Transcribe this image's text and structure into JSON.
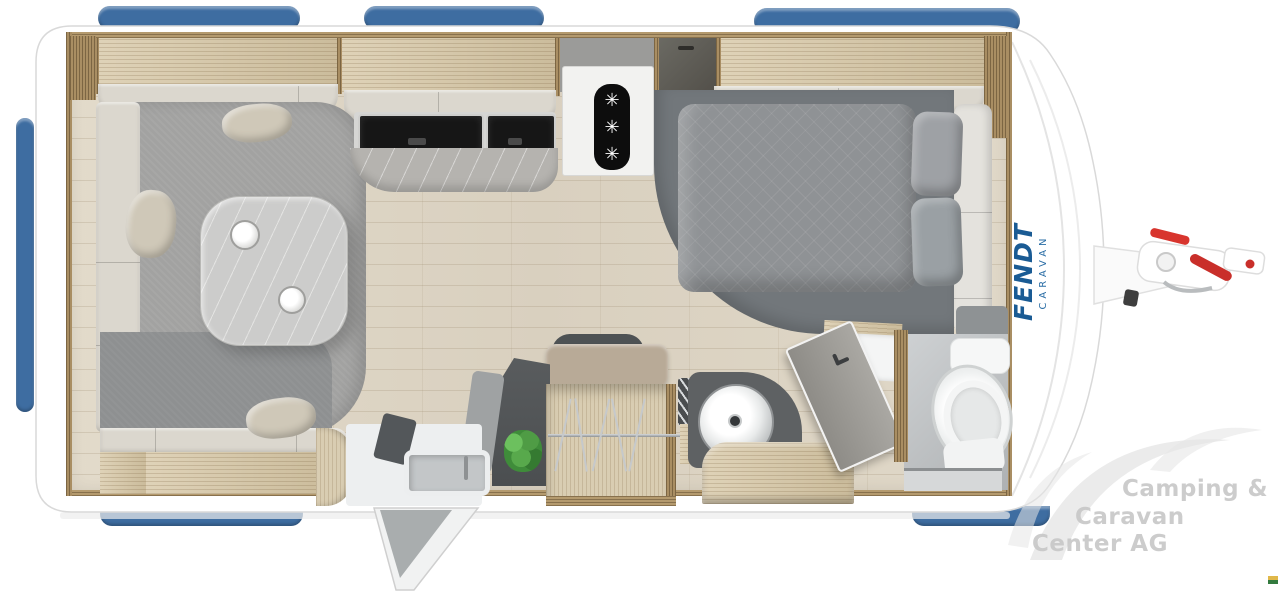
{
  "image": {
    "brand_panel": {
      "name": "FENDT",
      "sub": "CARAVAN",
      "color": "#1a5b94"
    },
    "dealer_watermark": {
      "lines": [
        "Camping &",
        "Caravan",
        "Center AG"
      ],
      "color": "#c8c8c8"
    },
    "icons": {
      "snowflake": "✳"
    },
    "colors": {
      "window_blue": "#3e6da1",
      "body_white": "#ffffff",
      "wood_wall": "#d6c6a4",
      "floor_plank": "#ded5c4",
      "rug_gray": "#a2a2a1",
      "sofa_cream": "#dbd7ce",
      "bed_duvet_gray": "#8f9295",
      "under_bed_gray": "#72777b",
      "cooktop_black": "#161616",
      "hitch_red": "#d23430",
      "plant_green": "#4c9440",
      "watermark_gray": "#c8c8c8",
      "corner_flag_yellow": "#e0b84a",
      "corner_flag_green": "#337a3e"
    }
  }
}
